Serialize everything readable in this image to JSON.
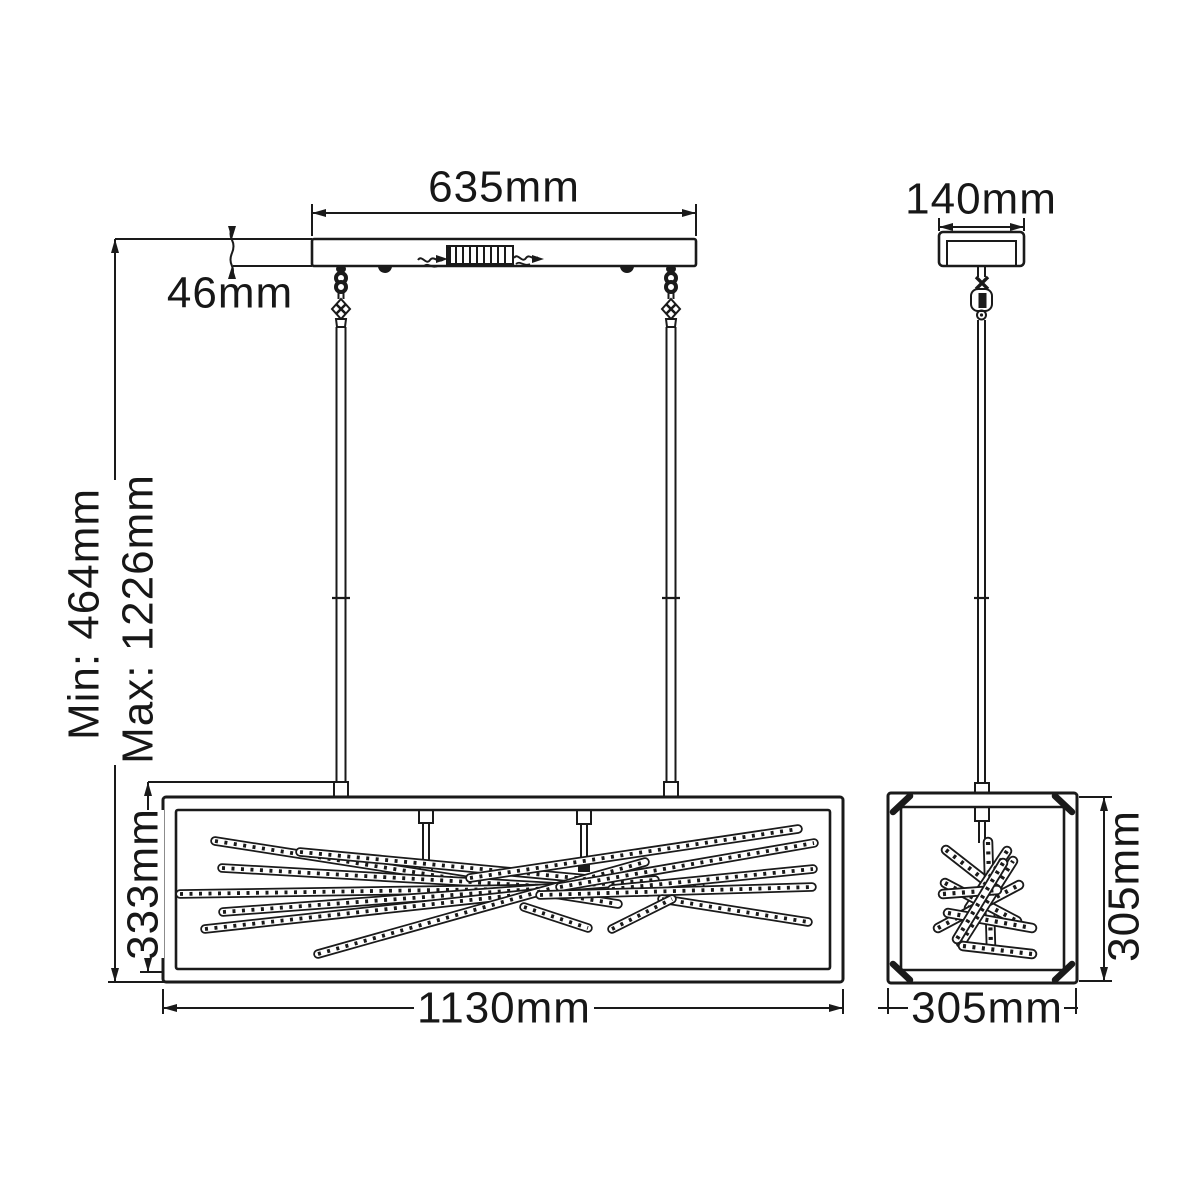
{
  "drawing": {
    "front_view": {
      "canopy_width_label": "635mm",
      "canopy_height_label": "46mm",
      "min_height_label": "Min: 464mm",
      "max_height_label": "Max: 1226mm",
      "shade_height_label": "333mm",
      "shade_width_label": "1130mm"
    },
    "side_view": {
      "canopy_width_label": "140mm",
      "shade_height_label": "305mm",
      "shade_width_label": "305mm"
    },
    "colors": {
      "line": "#1a1a1a",
      "background": "#ffffff"
    }
  }
}
